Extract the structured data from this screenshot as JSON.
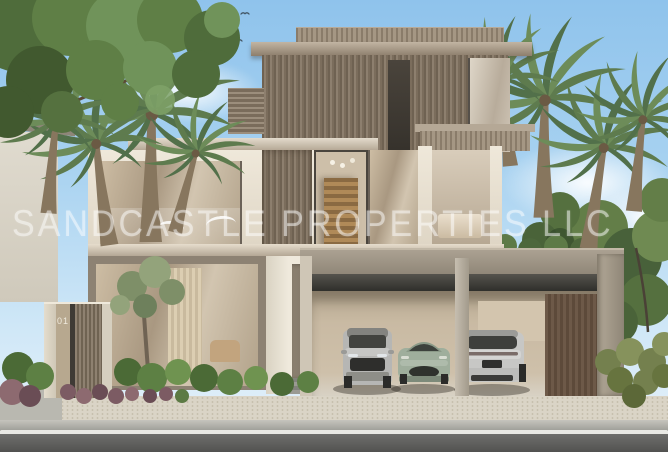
{
  "watermark": {
    "text": "SANDCASTLE PROPERTIES LLC",
    "color": "#ffffff",
    "opacity": "52%"
  },
  "entrance_gate": {
    "unit_number": "01"
  },
  "scene": {
    "setting": "daytime exterior rendering of a modern three-storey luxury villa",
    "sky": {
      "top": "#8fc3ec",
      "horizon": "#e8f2fa",
      "clouds": "soft white clouds left-centre and right",
      "birds": "small flock above the roof, upper left"
    },
    "vegetation": [
      "large green tree overhanging top-left corner",
      "date palms flanking the house left and right",
      "olive tree at the entrance",
      "clipped green shrubs and purple groundcover beds",
      "ornamental grasses at right"
    ],
    "house": {
      "storeys": 3,
      "materials": [
        "bronze vertical louvres",
        "warm taupe stone",
        "cream stone frames",
        "floor-to-ceiling glazing"
      ],
      "features": [
        "slatted roof parapet",
        "double-height stair window with timber stairs",
        "glass balustrade terrace",
        "open double carport"
      ]
    },
    "cars": [
      {
        "position": "left",
        "type": "SUV",
        "view": "front",
        "color": "silver"
      },
      {
        "position": "middle",
        "type": "sports coupe",
        "view": "front",
        "color": "sage green"
      },
      {
        "position": "right",
        "type": "fastback",
        "view": "rear",
        "color": "silver"
      }
    ],
    "street": {
      "sidewalk": "cream paver sidewalk",
      "road": "grey asphalt with white edge line"
    }
  },
  "palette": {
    "sky": "#9ccaed",
    "bronze_louvre": "#7d6f5f",
    "taupe_wall": "#9a8d7c",
    "cream_stone": "#e8e1d3",
    "garage_fascia": "#99907f",
    "foliage": "#55713f",
    "palm": "#5e7b4e",
    "road": "#6e6e6c",
    "paver": "#d8d2c4"
  }
}
